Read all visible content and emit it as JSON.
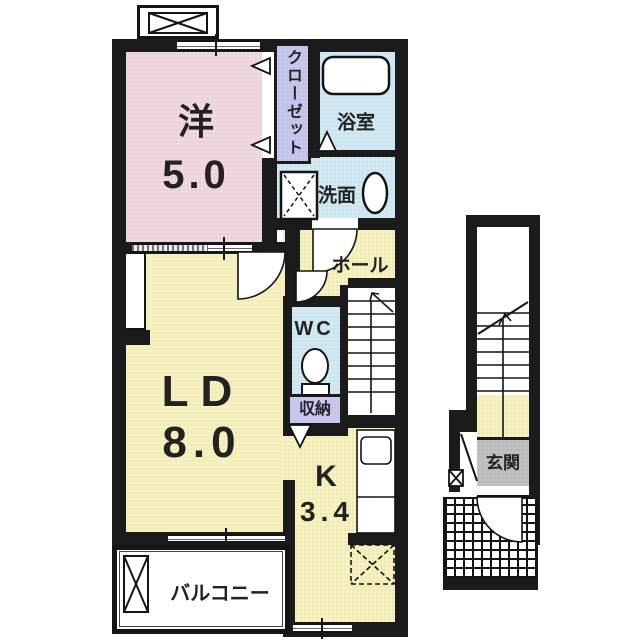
{
  "rooms": {
    "western": {
      "label": "洋",
      "area": "5.0"
    },
    "closet": {
      "label": "クローゼット"
    },
    "bath": {
      "label": "浴室"
    },
    "washroom": {
      "label": "洗面"
    },
    "hall": {
      "label": "ホール"
    },
    "wc": {
      "label": "WC"
    },
    "storage": {
      "label": "収納"
    },
    "living_dining": {
      "label": "LD",
      "area": "8.0"
    },
    "kitchen": {
      "label": "K",
      "area": "3.4"
    },
    "balcony": {
      "label": "バルコニー"
    },
    "entrance": {
      "label": "玄関"
    }
  },
  "colors": {
    "wall": "#1b1b1b",
    "western_room": "#f0d7e2",
    "closet": "#c7c7ee",
    "wet_area": "#d0e9f3",
    "living_area": "#f7f1bf",
    "entrance_floor": "#c0c0c0"
  },
  "icons": {
    "bathtub": "bathtub-icon",
    "toilet": "toilet-icon",
    "sink": "sink-oval-icon",
    "washing_machine_area": "washing-machine-area-icon",
    "kitchen_sink": "kitchen-sink-icon",
    "refrigerator_area": "refrigerator-area-icon",
    "stairs": "stairs-icon",
    "door_swing": "door-arc-icon"
  }
}
